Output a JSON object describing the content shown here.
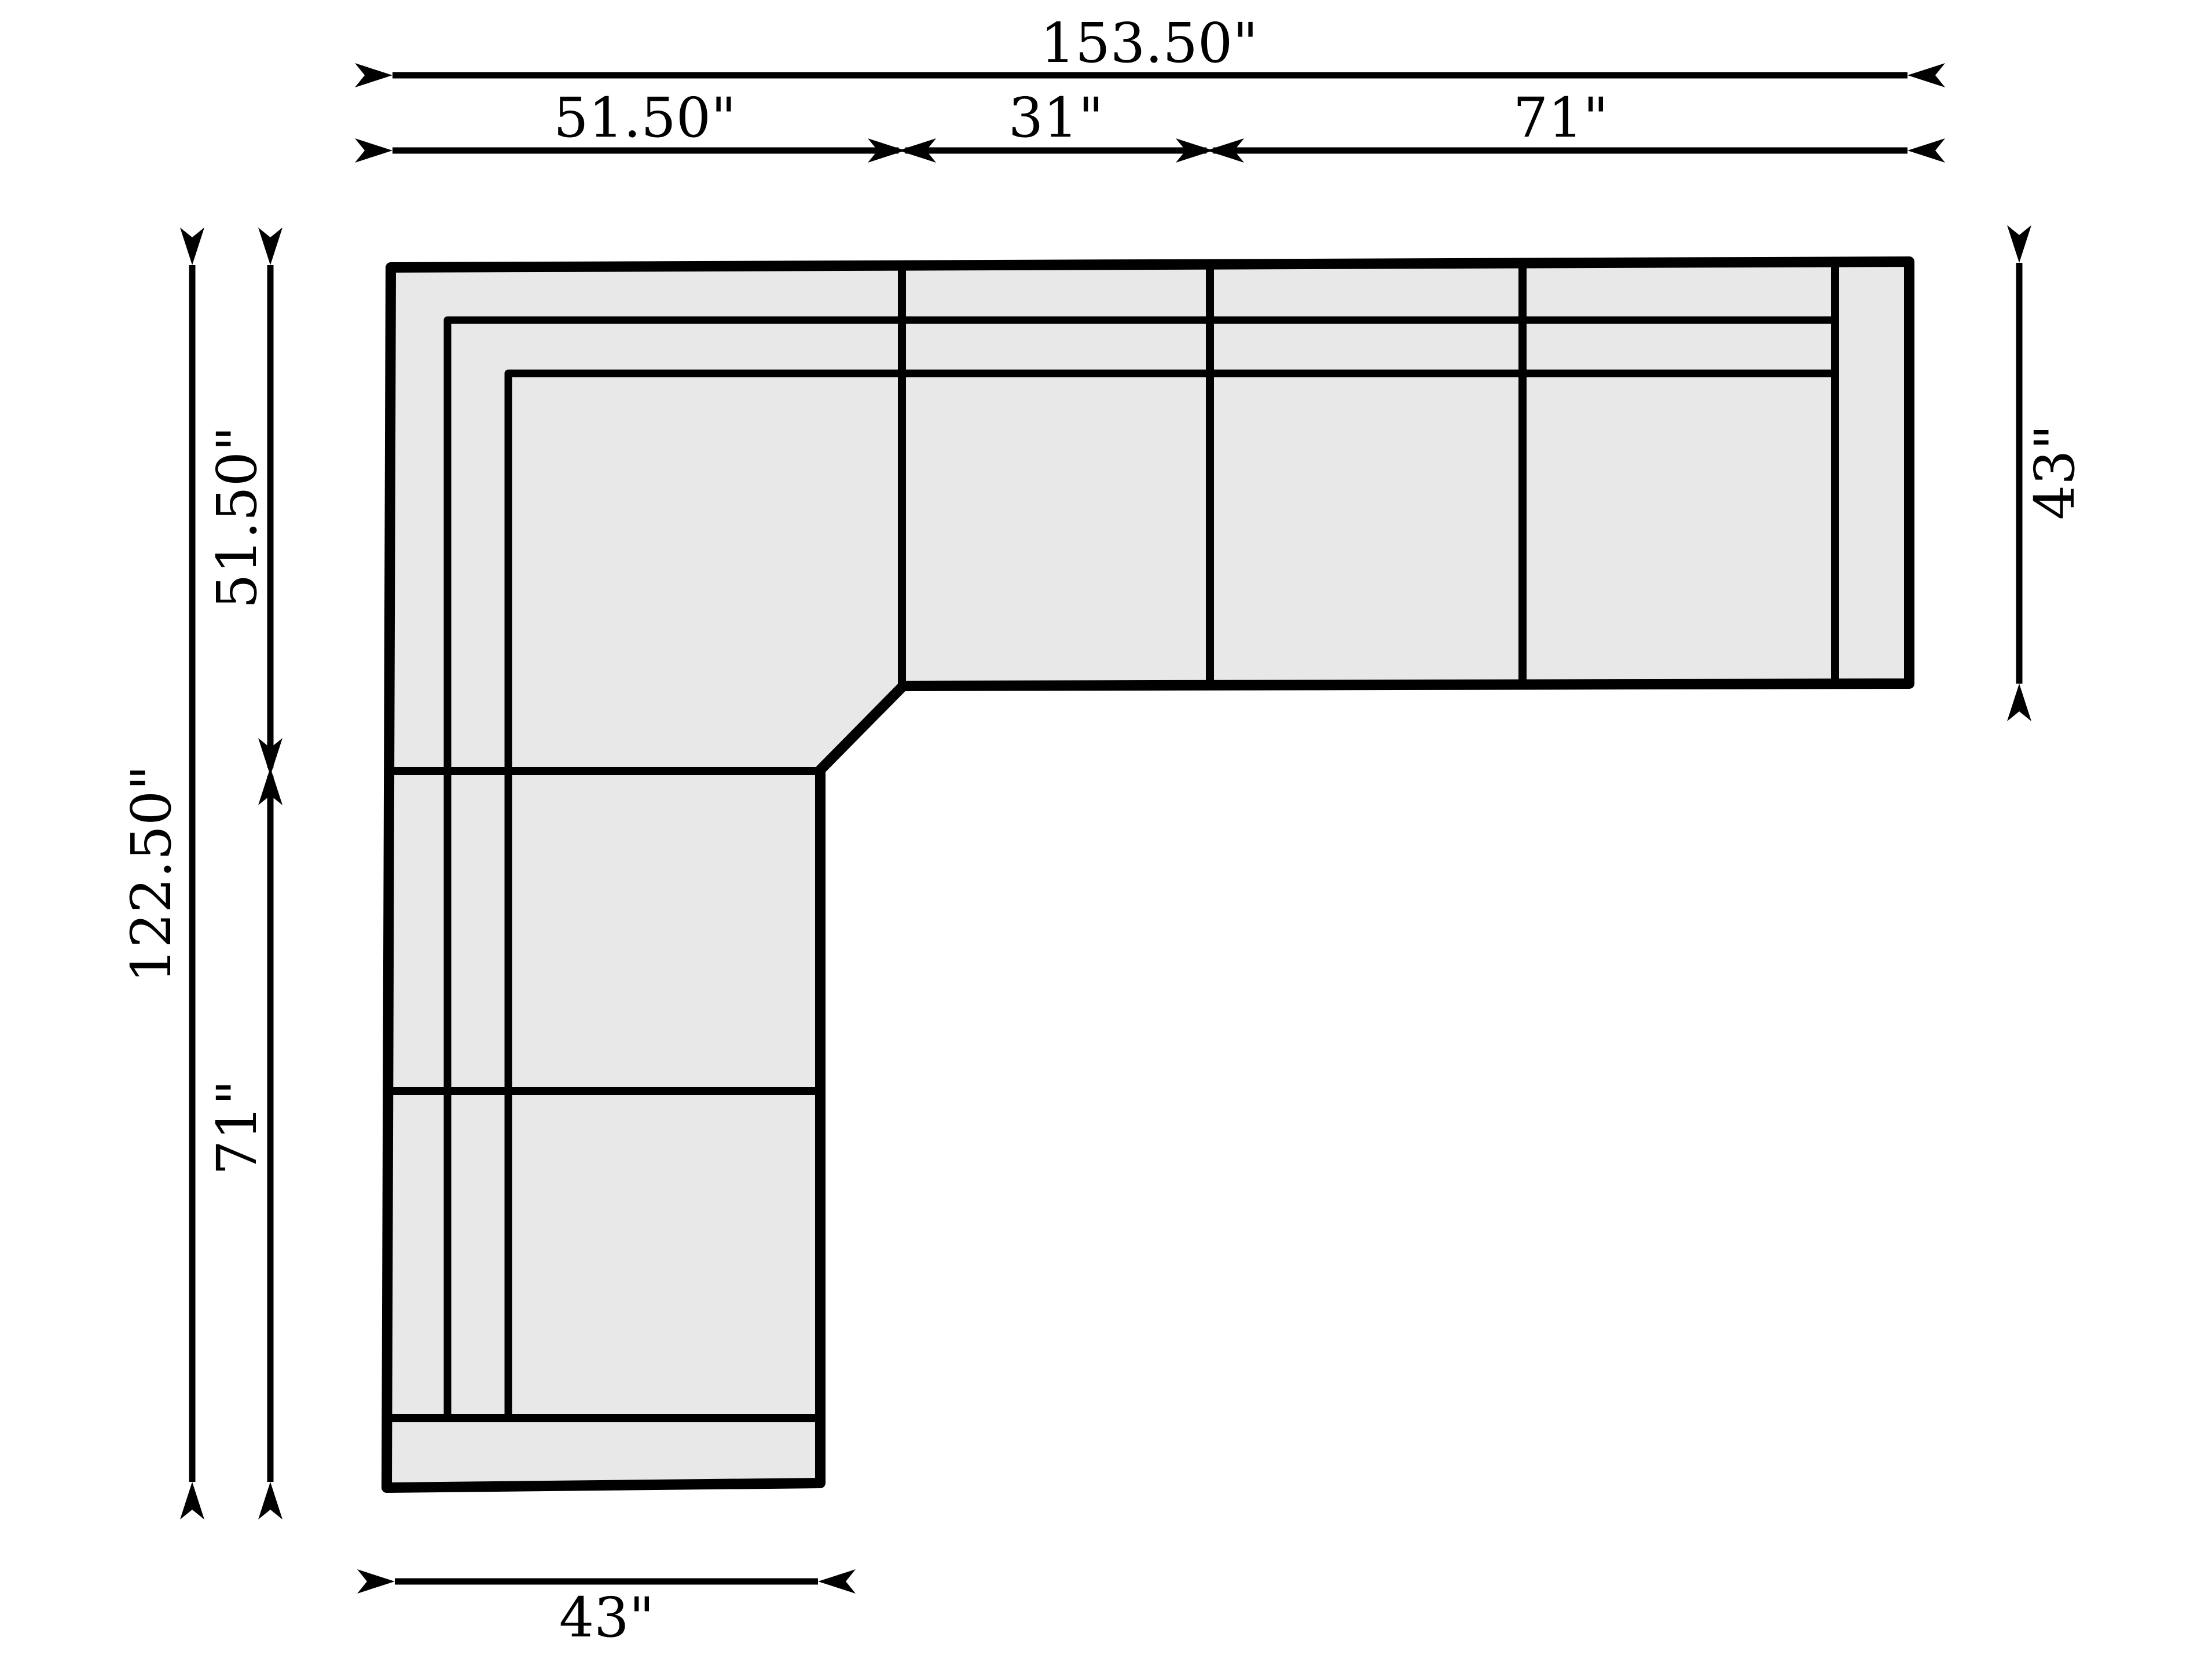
{
  "diagram": {
    "kind": "sectional-sofa-dimension-plan",
    "background_color": "#ffffff",
    "sofa_fill_color": "#e8e8e8",
    "line_color": "#000000"
  },
  "dims": {
    "total_width": "153.50\"",
    "top_left_section": "51.50\"",
    "top_middle_section": "31\"",
    "top_right_section": "71\"",
    "left_total_depth": "122.50\"",
    "left_upper_section": "51.50\"",
    "left_lower_section": "71\"",
    "right_depth": "43\"",
    "bottom_width": "43\""
  }
}
